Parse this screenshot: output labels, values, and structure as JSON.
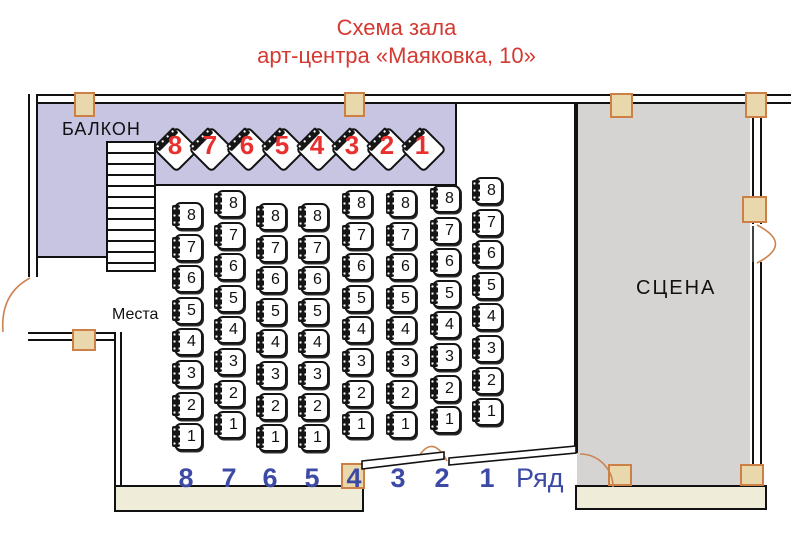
{
  "title": {
    "line1": "Схема зала",
    "line2": "арт-центра «Маяковка, 10»"
  },
  "balcony": {
    "label": "БАЛКОН",
    "seats": [
      "8",
      "7",
      "6",
      "5",
      "4",
      "3",
      "2",
      "1"
    ]
  },
  "stage": {
    "label": "СЦЕНА"
  },
  "floor": {
    "seats_label": "Места",
    "row_label": "Ряд",
    "row_numbers": [
      "8",
      "7",
      "6",
      "5",
      "4",
      "3",
      "2",
      "1"
    ],
    "rows": [
      {
        "row": "8",
        "seats": [
          "8",
          "7",
          "6",
          "5",
          "4",
          "3",
          "2",
          "1"
        ]
      },
      {
        "row": "7",
        "seats": [
          "8",
          "7",
          "6",
          "5",
          "4",
          "3",
          "2",
          "1"
        ]
      },
      {
        "row": "6",
        "seats": [
          "8",
          "7",
          "6",
          "5",
          "4",
          "3",
          "2",
          "1"
        ]
      },
      {
        "row": "5",
        "seats": [
          "8",
          "7",
          "6",
          "5",
          "4",
          "3",
          "2",
          "1"
        ]
      },
      {
        "row": "4",
        "seats": [
          "8",
          "7",
          "6",
          "5",
          "4",
          "3",
          "2",
          "1"
        ]
      },
      {
        "row": "3",
        "seats": [
          "8",
          "7",
          "6",
          "5",
          "4",
          "3",
          "2",
          "1"
        ]
      },
      {
        "row": "2",
        "seats": [
          "8",
          "7",
          "6",
          "5",
          "4",
          "3",
          "2",
          "1"
        ]
      },
      {
        "row": "1",
        "seats": [
          "8",
          "7",
          "6",
          "5",
          "4",
          "3",
          "2",
          "1"
        ]
      }
    ]
  },
  "colors": {
    "title_red": "#d43a31",
    "balcony_purple": "#c7c5e2",
    "stage_gray": "#d5d4d2",
    "wall_cream": "#f0ecda",
    "stud_fill": "#e9d8ab",
    "stud_border": "#cd8046",
    "row_number_blue": "#3c4aa5",
    "seat_number_red": "#e8312e",
    "door_orange": "#cc8352"
  }
}
